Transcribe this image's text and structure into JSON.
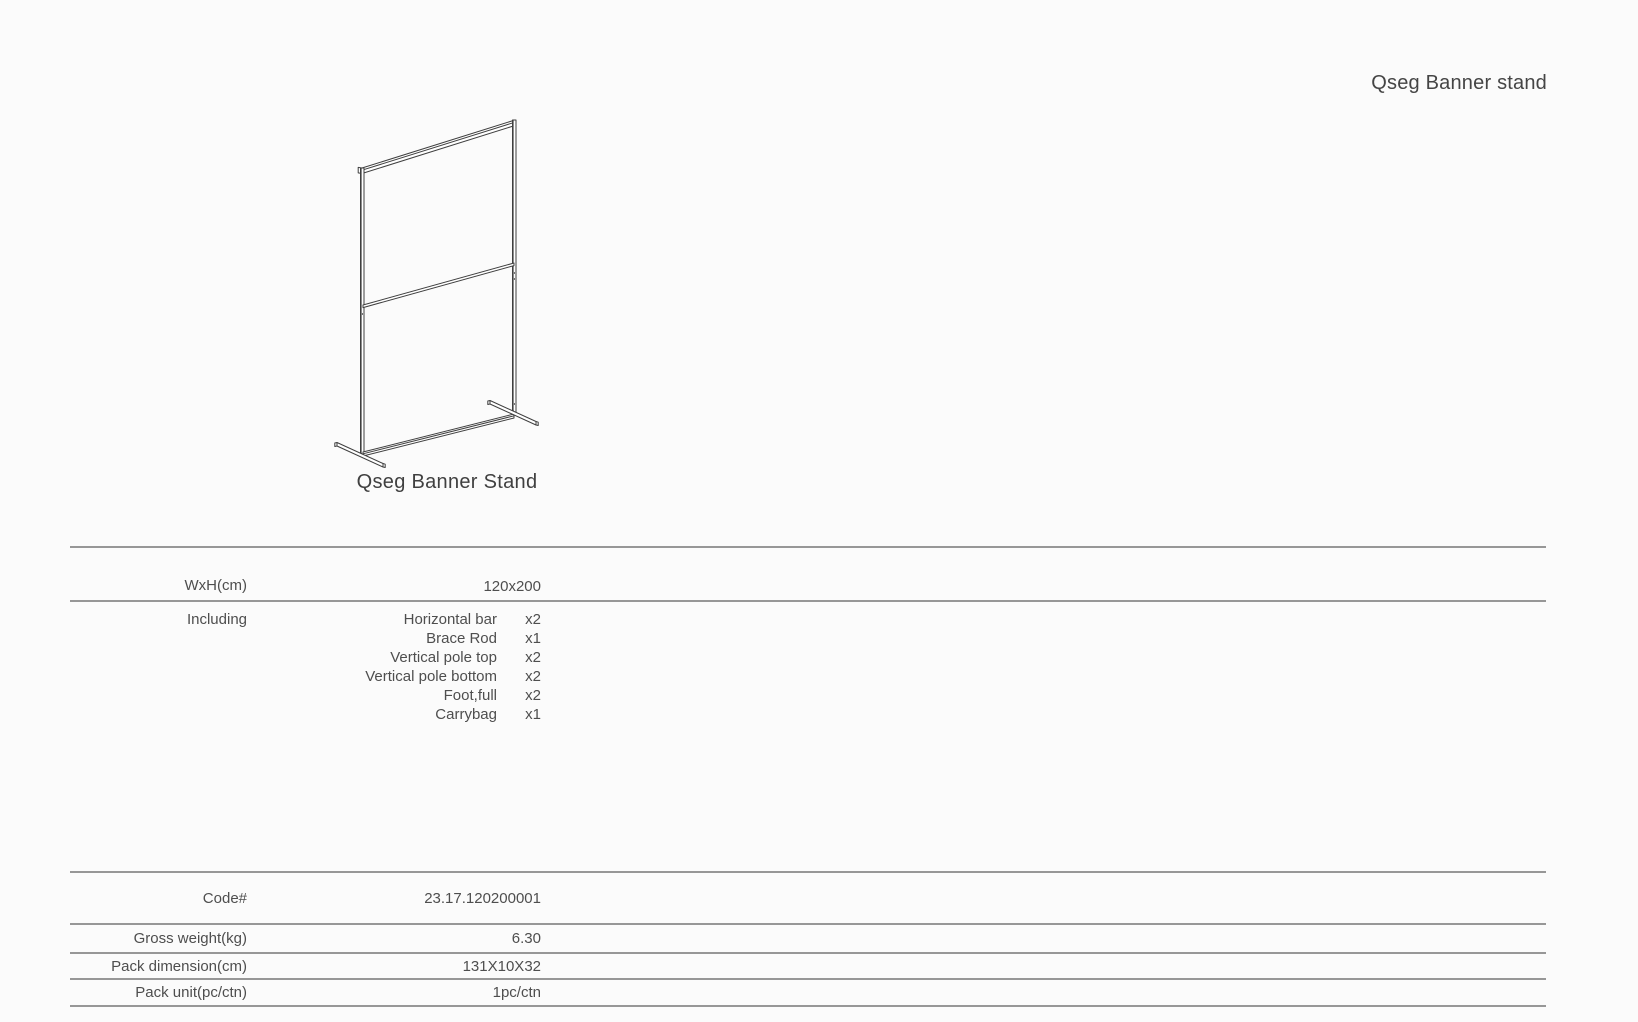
{
  "title_top_right": "Qseg Banner stand",
  "figure": {
    "caption": "Qseg Banner Stand",
    "drawing": "isometric line drawing of banner stand frame"
  },
  "spec": {
    "wxh": {
      "label": "WxH(cm)",
      "value": "120x200"
    },
    "including": {
      "label": "Including",
      "items": [
        {
          "name": "Horizontal bar",
          "qty": "x2"
        },
        {
          "name": "Brace Rod",
          "qty": "x1"
        },
        {
          "name": "Vertical pole top",
          "qty": "x2"
        },
        {
          "name": "Vertical pole bottom",
          "qty": "x2"
        },
        {
          "name": "Foot,full",
          "qty": "x2"
        },
        {
          "name": "Carrybag",
          "qty": "x1"
        }
      ]
    },
    "code": {
      "label": "Code#",
      "value": "23.17.120200001"
    },
    "gross_weight": {
      "label": "Gross weight(kg)",
      "value": "6.30"
    },
    "pack_dimension": {
      "label": "Pack dimension(cm)",
      "value": "131X10X32"
    },
    "pack_unit": {
      "label": "Pack unit(pc/ctn)",
      "value": "1pc/ctn"
    }
  },
  "colors": {
    "text": "#4e4e4e",
    "rule": "#979797",
    "drawing_stroke": "#3f3f3f",
    "background": "#fbfbfb"
  }
}
